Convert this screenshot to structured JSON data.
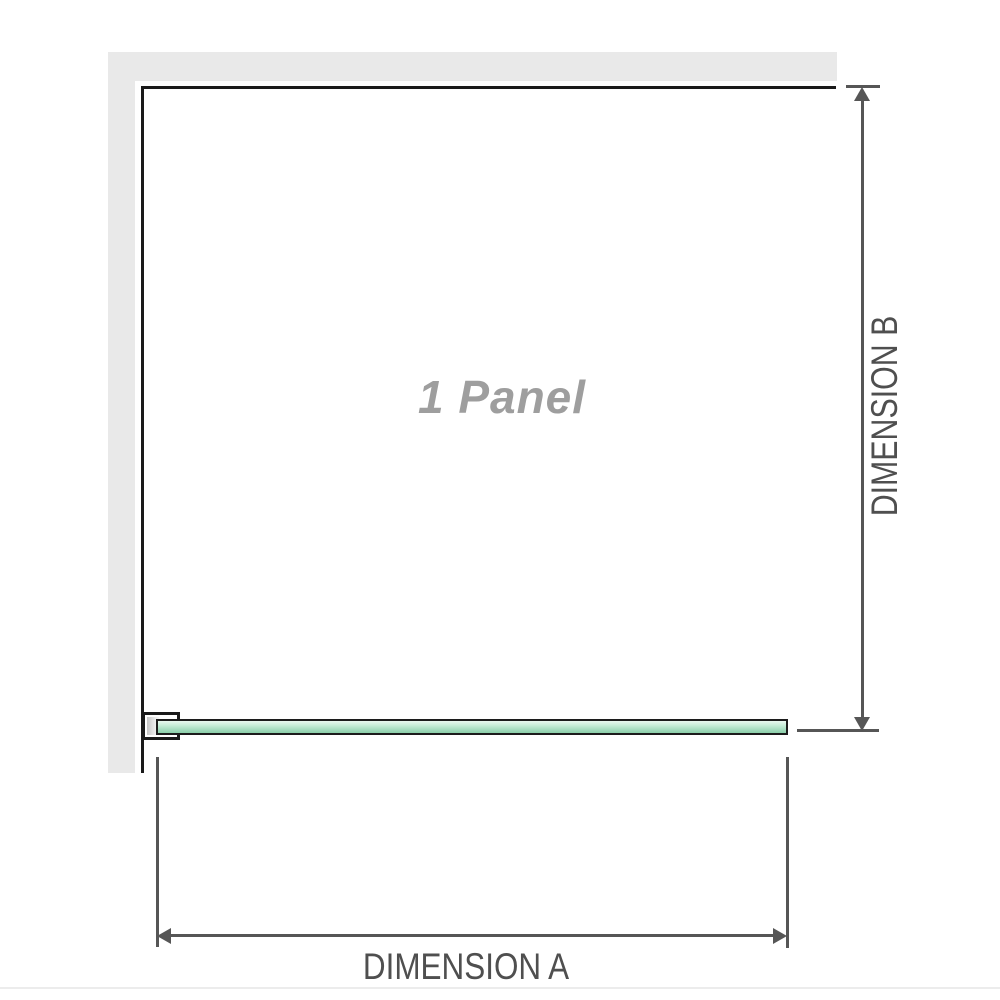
{
  "diagram": {
    "panel_label": "1 Panel",
    "dimension_a_label": "DIMENSION A",
    "dimension_b_label": "DIMENSION B"
  },
  "colors": {
    "wall": "#e9e9e9",
    "outline": "#1a1a1a",
    "dim": "#565656",
    "dim-text": "#4f4f4f",
    "panel-text": "#9e9e9e",
    "glass-light": "#eaf7f0",
    "glass-mid": "#a7dcc0",
    "glass-dark": "#8bcfa9",
    "baseline": "#ececec"
  }
}
